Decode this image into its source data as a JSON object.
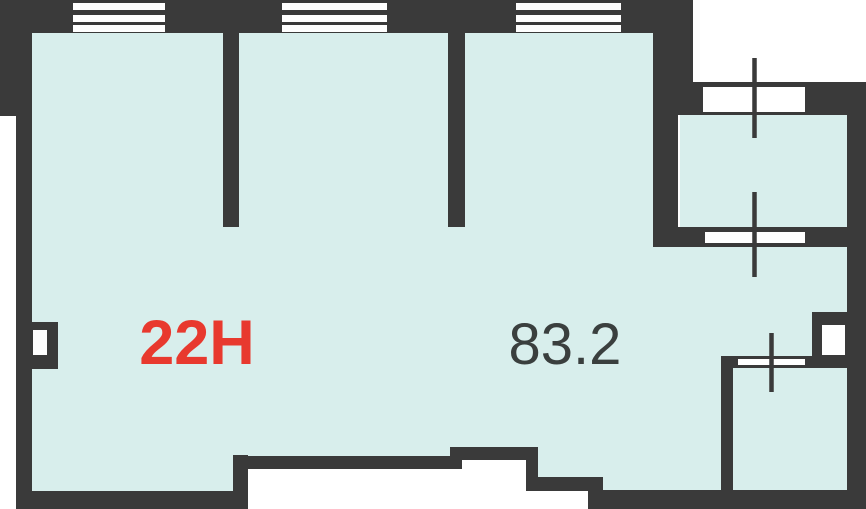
{
  "plan": {
    "unit_label": "22H",
    "area_label": "83.2"
  },
  "colors": {
    "wall": "#3a3a3a",
    "interior": "#d8eeec",
    "accent": "#e8392e",
    "text": "#3a3f3e",
    "bg": "#ffffff"
  }
}
